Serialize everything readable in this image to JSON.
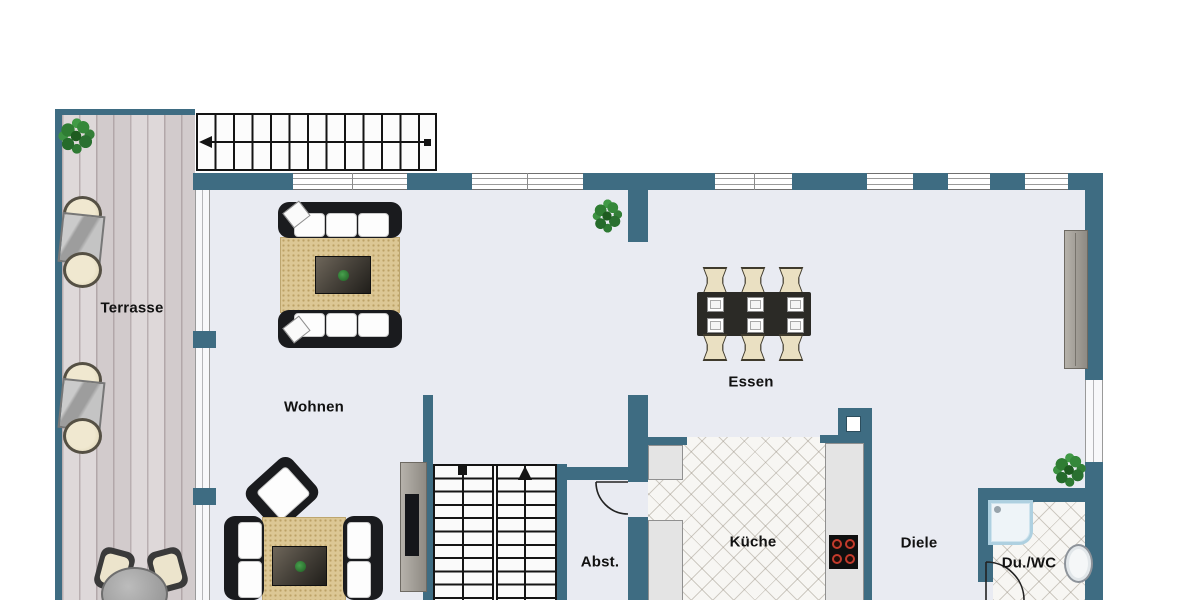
{
  "floorplan": {
    "type": "residential-floor-plan",
    "language": "de",
    "rooms": [
      {
        "id": "terrasse",
        "label": "Terrasse"
      },
      {
        "id": "wohnen",
        "label": "Wohnen"
      },
      {
        "id": "essen",
        "label": "Essen"
      },
      {
        "id": "abst",
        "label": "Abst."
      },
      {
        "id": "kueche",
        "label": "Küche"
      },
      {
        "id": "diele",
        "label": "Diele"
      },
      {
        "id": "duwc",
        "label": "Du./WC"
      }
    ],
    "stairs": [
      {
        "id": "exterior-top",
        "direction": "left",
        "treads": 13
      },
      {
        "id": "interior",
        "direction": "up",
        "flights": 2
      }
    ],
    "furniture": [
      "corner plant",
      "two lounge-chair pairs with glass tables",
      "round patio table with chairs",
      "sofa group with rug and coffee table",
      "second sofa group with armchair",
      "dining table with six chairs and placemats",
      "tv board",
      "sideboard",
      "kitchen counters with stove",
      "shower",
      "washbasin",
      "plants"
    ],
    "colors": {
      "wall": "#3e6c82",
      "floor": "#e9ebf2",
      "terrace_deck": "#d8d2d3",
      "tile": "#f7f6f3",
      "rug": "#dcc795",
      "sofa": "#1a1b1e",
      "cushion": "#fdfdfd",
      "coffee_table": "#49443c",
      "dining_table": "#2b2a26",
      "chair_cream": "#eae0c2",
      "counter": "#e4e4e4",
      "stove": "#111111",
      "burner_ring": "#c33b2c",
      "shower_border": "#aed0e0",
      "plant": "#2e7d32",
      "label_text": "#111111",
      "stair_line": "#141414"
    }
  }
}
